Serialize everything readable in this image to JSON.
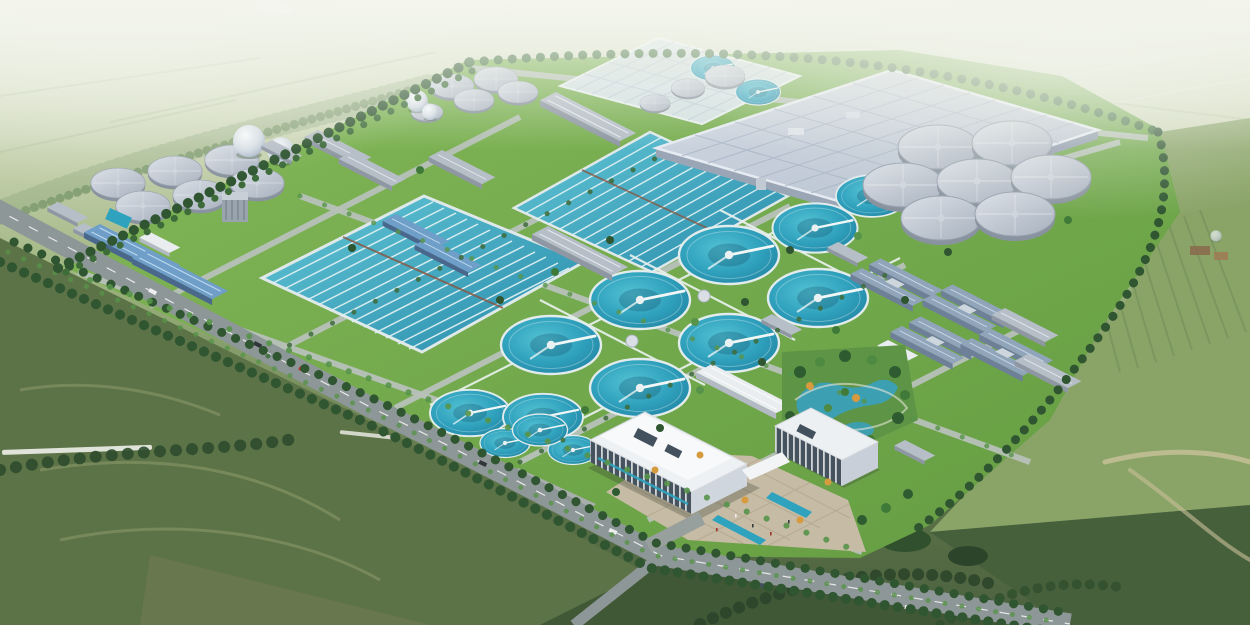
{
  "scene": {
    "description": "Aerial architectural rendering of a large wastewater treatment plant campus: rectangular aeration basins and rows of circular clarifiers in teal water, gray sludge digester tanks, white gas-holder spheres, a large covered basin roof, blue-roofed process buildings, a white administration complex with entrance plaza and landscaped pond garden, all bounded by a tree-lined road and surrounded by green farmland under a hazy horizon.",
    "features": [
      "aeration-basins",
      "circular-clarifiers",
      "digester-tanks",
      "gas-spheres",
      "covered-basin-roof",
      "process-buildings",
      "admin-complex",
      "entrance-plaza",
      "pond-garden",
      "perimeter-road",
      "tree-rows",
      "farm-fields"
    ]
  },
  "palette": {
    "waterTeal": "#2fa7c0",
    "waterDeep": "#1f86a8",
    "grass": "#76ad4e",
    "grassDark": "#4e7a38",
    "fieldDark": "#55683f",
    "fieldLight": "#ccd6b8",
    "roofGray": "#c9d2de",
    "roofBlue": "#6f9fc8",
    "road": "#8e9797",
    "concrete": "#c8ccd2",
    "plaza": "#c6bba4",
    "treeDark": "#2f5531",
    "treeLight": "#57944a",
    "autumn": "#d79b3f",
    "haze": "#eef2e6"
  }
}
